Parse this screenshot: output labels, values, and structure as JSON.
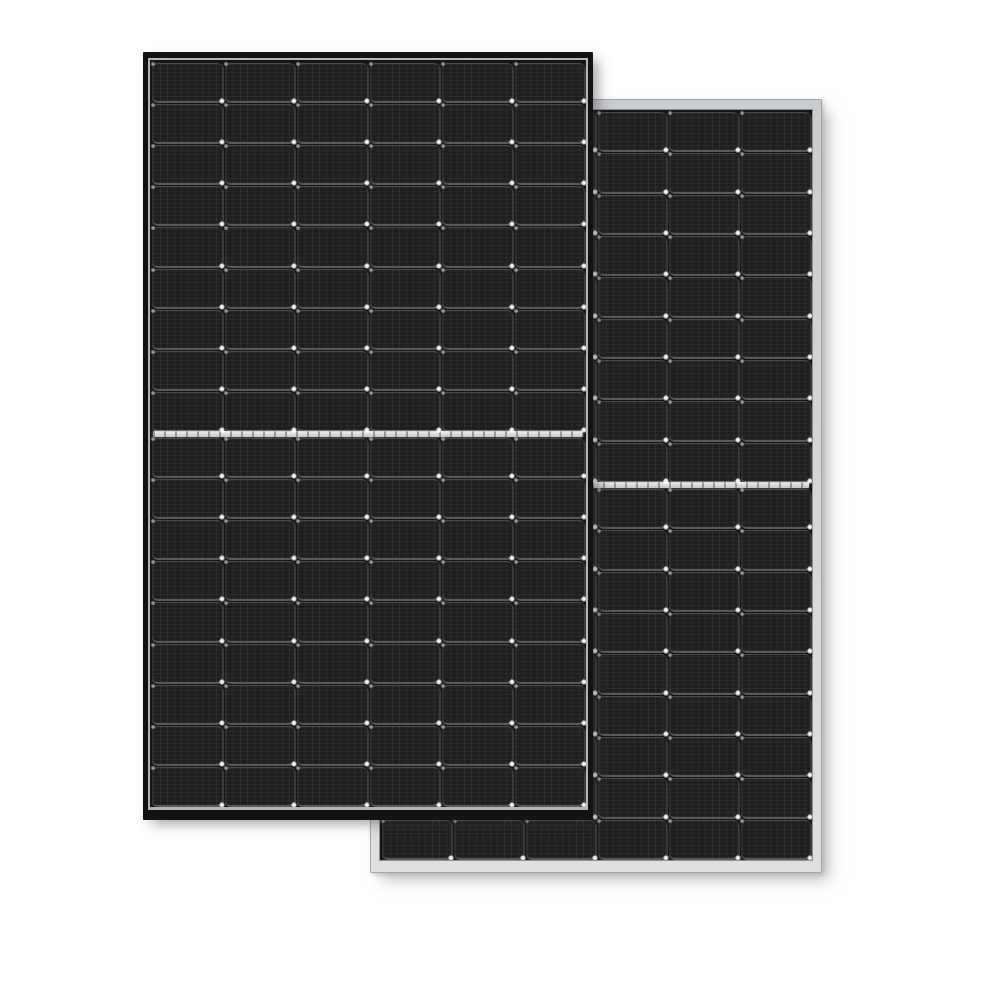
{
  "scene": {
    "type": "product-photo",
    "subject": "Two overlapping half-cut-cell monocrystalline solar panels on a white background",
    "background_color": "#ffffff"
  },
  "panels": {
    "rear": {
      "description": "silver-framed solar panel standing behind, offset right and down",
      "x": 370,
      "y": 99,
      "width": 452,
      "height": 774,
      "grid": {
        "columns": 6,
        "top_rows": 9,
        "bottom_rows": 9,
        "total_cells": 108
      },
      "colors": {
        "frame-top": "#c9ccce",
        "frame-bottom": "#dddfe0",
        "frame-edge": "#a2a6a8",
        "inner-edge": "#8e9294",
        "backsheet": "#141414",
        "cell": "#1f1f1f",
        "divider-a": "#f0f0f0",
        "divider-b": "#c4c4c4"
      },
      "shadow": "9px 9px 14px -2px rgba(150,154,157,0.60), 2px 2px 4px rgba(165,168,170,0.50)"
    },
    "front": {
      "description": "black-framed solar panel in front, offset left and up",
      "x": 143,
      "y": 52,
      "width": 450,
      "height": 768,
      "grid": {
        "columns": 6,
        "top_rows": 9,
        "bottom_rows": 9,
        "total_cells": 108
      },
      "colors": {
        "frame": "#131313",
        "inner-lip": "#b4b4b4",
        "backsheet": "#161616",
        "cell": "#1f1f1f",
        "divider-a": "#f2f2f2",
        "divider-b": "#c6c6c6"
      },
      "shadow": "7px 6px 12px -2px rgba(50,52,55,0.45)"
    }
  }
}
